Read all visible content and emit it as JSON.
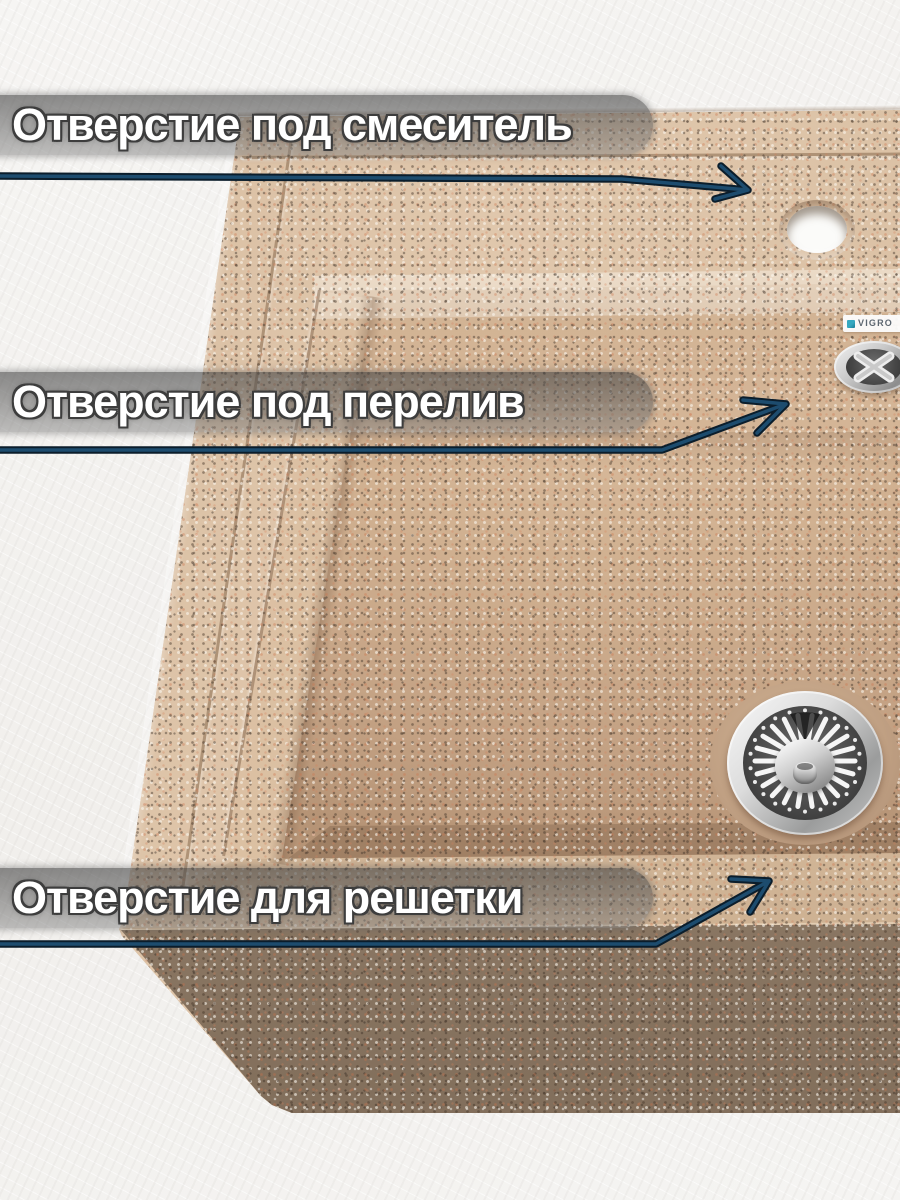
{
  "annotations": {
    "items": [
      {
        "label": "Отверстие под смеситель",
        "target": "faucet-hole"
      },
      {
        "label": "Отверстие под перелив",
        "target": "overflow-hole"
      },
      {
        "label": "Отверстие для решетки",
        "target": "drain-hole"
      }
    ]
  },
  "brand": {
    "name": "VIGRO"
  },
  "palette": {
    "background": "#f4f3f1",
    "sink_sand": "#dcc2a6",
    "bowl_floor": "#c9a98a",
    "front_face": "#8d7965",
    "callout_bar_gray": "#969696",
    "arrow_navy": "#1d4c6e",
    "chrome": "#d9d9d9"
  }
}
